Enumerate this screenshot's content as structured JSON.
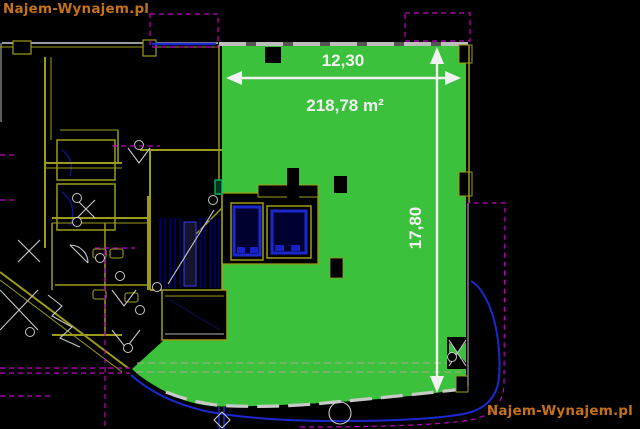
{
  "watermarks": {
    "top_left": "Najem-Wynajem.pl",
    "bottom_right": "Najem-Wynajem.pl",
    "color": "#c4711c"
  },
  "floor_plan": {
    "unit_area": {
      "area_label": "218,78 m²",
      "width_dimension": "12,30",
      "height_dimension": "17,80",
      "highlight_color": "#3cc13c",
      "dimension_text_color": "#f2f2f2"
    },
    "drawing_colors": {
      "background": "#000000",
      "walls_yellow": "#9c9c1a",
      "outline_white": "#c9c9c9",
      "fixtures_blue": "#1c28cf",
      "section_magenta": "#c000c0",
      "stair_hatch_blue": "#0000bb"
    }
  }
}
